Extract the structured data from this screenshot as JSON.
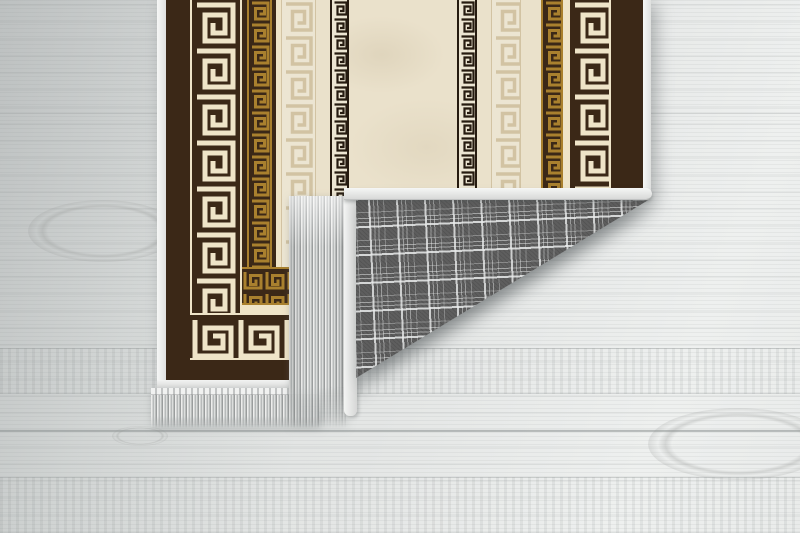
{
  "scene": {
    "description": "Product photo of a cream and dark-brown Greek-key (meander) runner rug lying on a whitewashed wood plank floor; the bottom-right corner is folded over, revealing a gray tartan-plaid woven backing edged with white binding and gray fringe tassels; more fringe hangs along the rug's bottom edge.",
    "objects": {
      "floor": "whitewashed wood planks, horizontal grain",
      "rug_front": "symmetric vertical stripes of Greek-key meander borders in dark brown, cream, gold and black; border turns horizontally at the bottom-left corner",
      "rug_back": "gray windowpane plaid weave",
      "fringe": "light gray tassel fringe",
      "binding": "white edge binding strips"
    },
    "colors": {
      "wood-dark": "#d2d5d5",
      "wood-mid": "#e4e6e5",
      "wood-light": "#eef0ef",
      "rug-brown": "#3b2817",
      "rug-cream": "#eae1cb",
      "rug-cream2": "#ece5d2",
      "rug-cream-line": "#efe4c8",
      "rug-gold": "#a9802e",
      "rug-beige": "#d2c3a3",
      "rug-black": "#261b10",
      "plaid-base": "#5e5e5e",
      "plaid-line": "#e9ebeb",
      "fringe-light": "#ededec",
      "fringe-mid": "#b7baba",
      "fringe-dark": "#9a9d9d",
      "binding-white": "#f2f3f2"
    }
  }
}
